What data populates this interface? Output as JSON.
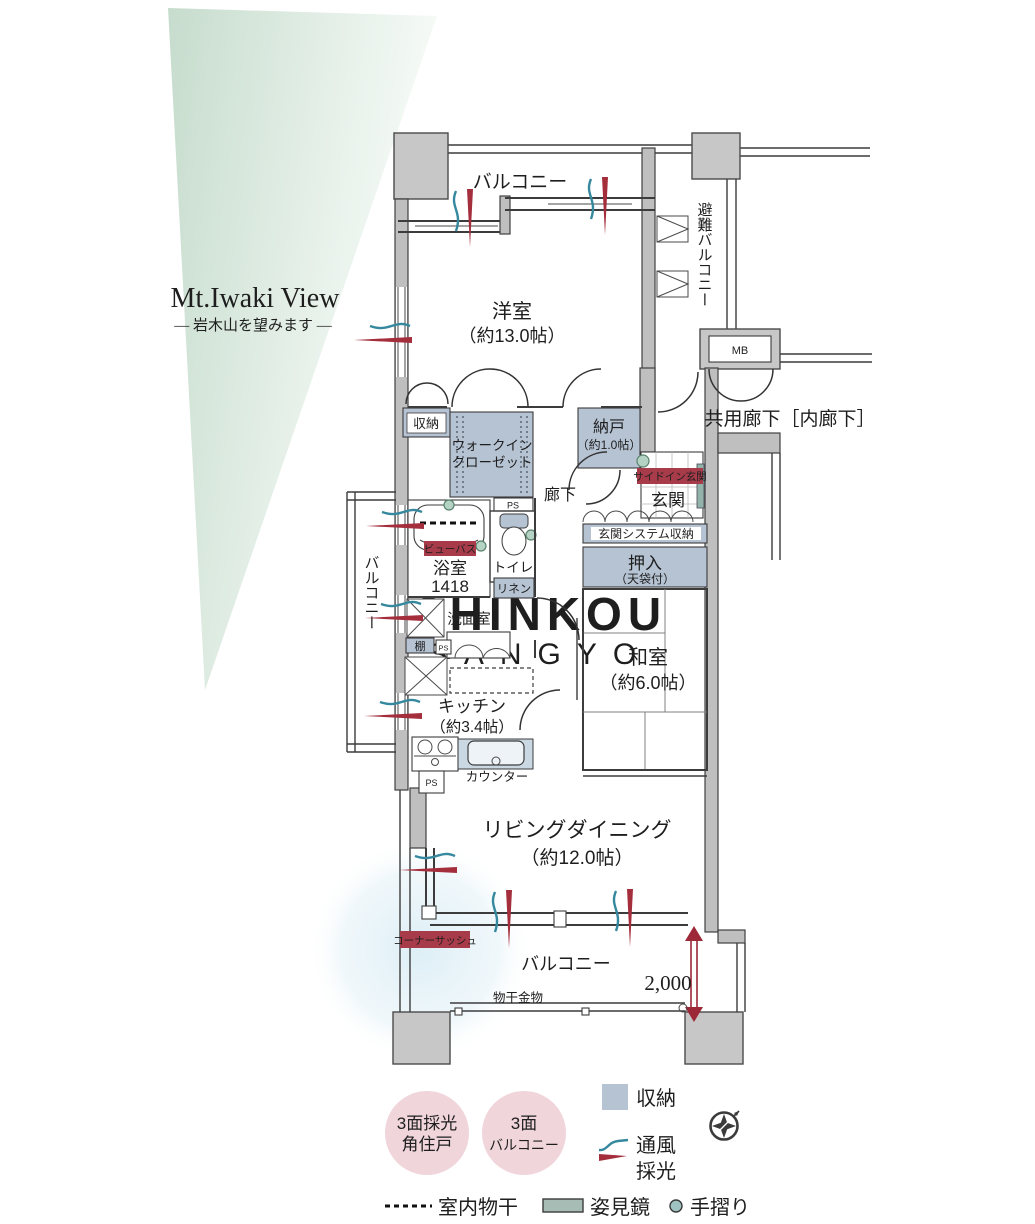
{
  "view_note": {
    "title": "Mt.Iwaki View",
    "subtitle": "— 岩木山を望みます —"
  },
  "plan": {
    "balcony_top": "バルコニー",
    "yoshitsu_name": "洋室",
    "yoshitsu_size": "（約13.0帖）",
    "evac_balcony": "避難バルコニー",
    "mb": "MB",
    "corridor": "共用廊下［内廊下］",
    "shuno": "収納",
    "wic_line1": "ウォークイン",
    "wic_line2": "クローゼット",
    "nando_name": "納戸",
    "nando_size": "（約1.0帖）",
    "rouka": "廊下",
    "side_in_genkan": "サイドイン玄関",
    "genkan": "玄関",
    "genkan_storage": "玄関システム収納",
    "oshiire_name": "押入",
    "oshiire_size": "（天袋付）",
    "view_bath": "ビューバス",
    "bath_name": "浴室",
    "bath_size": "1418",
    "toilet": "トイレ",
    "linen": "リネン",
    "ps": "PS",
    "senmen": "洗面室",
    "tana": "棚",
    "washitsu_name": "和室",
    "washitsu_size": "（約6.0帖）",
    "kitchen_name": "キッチン",
    "kitchen_size": "（約3.4帖）",
    "counter": "カウンター",
    "ld_name": "リビングダイニング",
    "ld_size": "（約12.0帖）",
    "corner_sash": "コーナーサッシュ",
    "balcony_left": "バルコニー",
    "balcony_bottom": "バルコニー",
    "monohoshi": "物干金物",
    "dim_2000": "2,000"
  },
  "legend": {
    "badge1_line1": "3面採光",
    "badge1_line2": "角住戸",
    "badge2_line1": "3面",
    "badge2_line2": "バルコニー",
    "storage": "収納",
    "ventilation": "通風",
    "daylight": "採光",
    "indoor_drying": "室内物干",
    "mirror": "姿見鏡",
    "handrail": "手摺り"
  },
  "watermark": {
    "line1": "SHINKOU",
    "line2": "SANGYO"
  },
  "colors": {
    "storage_fill": "#b6c3d3",
    "badge_pink": "#f0d5db",
    "red_label": "#a73b4a",
    "vent_teal": "#35889e",
    "daylight_red": "#a42e3c",
    "triangle_green": "#c6dccd",
    "handrail_green": "#b5d3c4",
    "mirror_green": "#93b2aa",
    "wall_gray": "#c7c7c7"
  }
}
